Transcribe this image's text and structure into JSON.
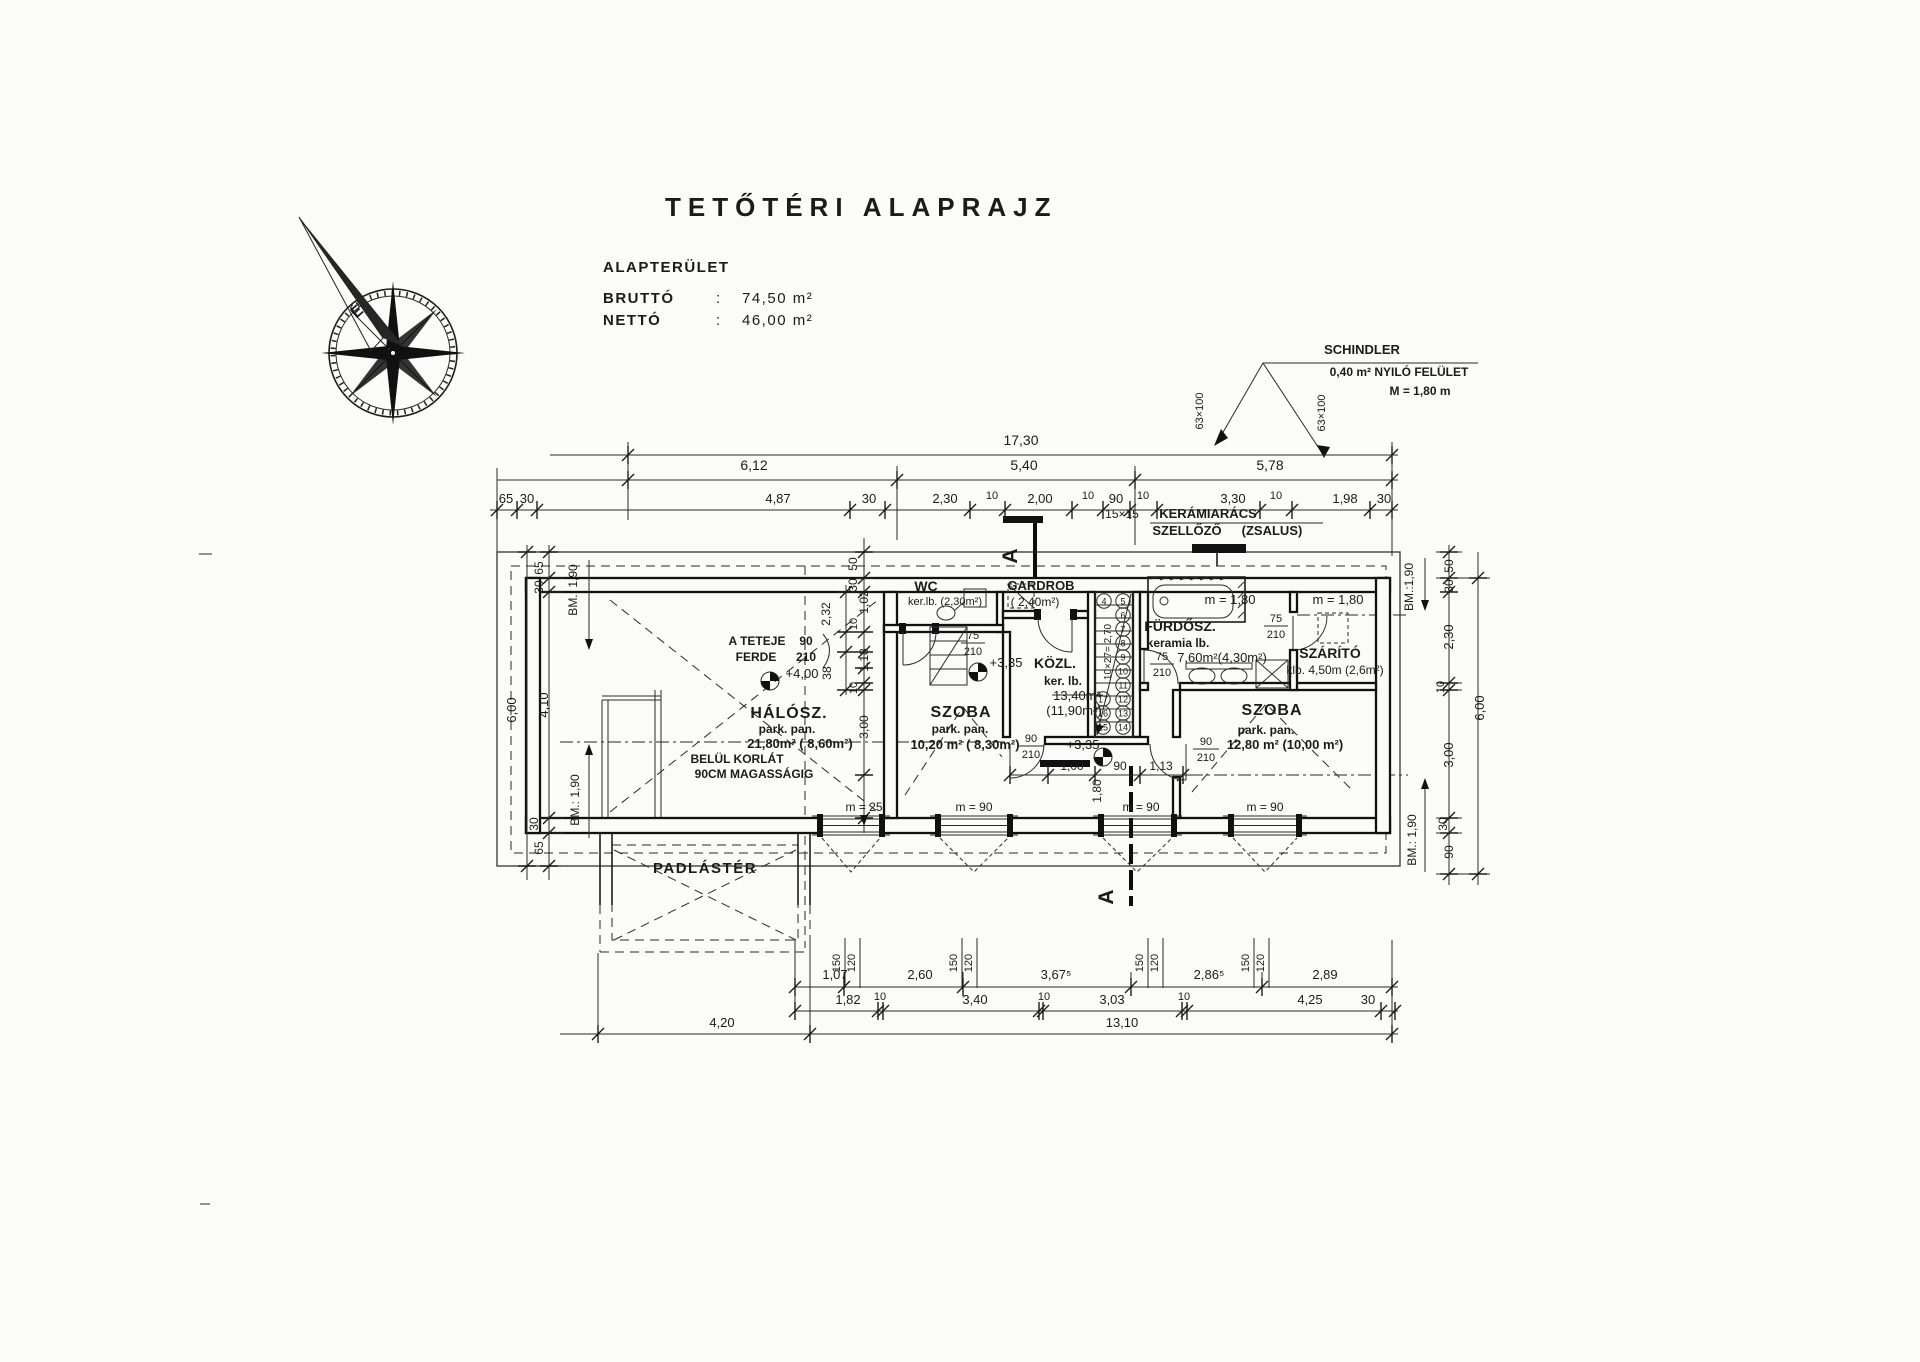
{
  "title": "TETŐTÉRI ALAPRAJZ",
  "area_table": {
    "heading": "ALAPTERÜLET",
    "rows": [
      {
        "label": "BRUTTÓ",
        "colon": ":",
        "value": "74,50 m²"
      },
      {
        "label": "NETTÓ",
        "colon": ":",
        "value": "46,00 m²"
      }
    ]
  },
  "compass": {
    "north_letter": "É"
  },
  "schindler": {
    "name": "SCHINDLER",
    "area": "0,40 m² NYILÓ FELÜLET",
    "height": "M = 1,80 m",
    "window_size_left": "63×100",
    "window_size_right": "63×100"
  },
  "vent": {
    "grid": "15×15",
    "name": "KERÁMIARÁCS",
    "type": "SZELLŐZŐ",
    "shutter": "(ZSALUS)"
  },
  "section": {
    "label_top": "A",
    "label_bottom": "A"
  },
  "levels": {
    "ridge": "+4,00",
    "floor1": "+3,35",
    "floor2": "+3,35"
  },
  "roof_note": {
    "line1_label": "A TETEJE",
    "line1_value": "90",
    "line2_label": "FERDE",
    "line2_value": "210"
  },
  "railing_note": {
    "line1": "BELÜL KORLÁT",
    "line2": "90CM MAGASSÁGIG"
  },
  "rooms": {
    "haloszoba": {
      "name": "HÁLÓSZ.",
      "finish": "park. pan.",
      "area": "21,80m² ( 8,60m²)"
    },
    "wc": {
      "name": "WC",
      "finish": "ker.lb. (2,30m²)"
    },
    "gardrob": {
      "name": "GARDROB",
      "area": "( 2,40m²)"
    },
    "kozlekedo": {
      "name": "KÖZL.",
      "finish": "ker. lb.",
      "area_gross": "13,40m²",
      "area_net": "(11,90m²)"
    },
    "furdoszoba": {
      "name": "FÜRDŐSZ.",
      "finish": "keramia lb.",
      "area": "7,60m²(4,30m²)",
      "tub_length": "m = 1,80"
    },
    "szarito": {
      "name": "SZÁRÍTÓ",
      "area": "klb. 4,50m (2,6m²)",
      "height": "m = 1,80"
    },
    "szoba_left": {
      "name": "SZOBA",
      "finish": "park. pan.",
      "area": "10,20 m² ( 8,30m²)"
    },
    "szoba_right": {
      "name": "SZOBA",
      "finish": "park. pan.",
      "area": "12,80 m² (10,00 m²)"
    },
    "padlaster": {
      "name": "PADLÁSTÉR"
    }
  },
  "stairs": {
    "run": "10×27= 2,70",
    "steps": [
      "4",
      "5",
      "6",
      "7",
      "8",
      "9",
      "10",
      "11",
      "12",
      "13",
      "14",
      "15",
      "16",
      "17"
    ]
  },
  "sills": {
    "w1": "m = 25",
    "w2": "m = 90",
    "w3": "m = 90",
    "w4": "m = 90"
  },
  "doors": {
    "d90a": {
      "w": "90",
      "h": "210"
    },
    "d90b": {
      "w": "90",
      "h": "210"
    },
    "d75a": {
      "w": "75",
      "h": "210"
    },
    "d75b": {
      "w": "75",
      "h": "210"
    },
    "d75c": {
      "w": "75",
      "h": "210"
    }
  },
  "dims": {
    "top_total": "17,30",
    "top_mid": [
      "6,12",
      "5,40",
      "5,78"
    ],
    "top_detail": [
      "65",
      "30",
      "4,87",
      "30",
      "2,30",
      "10",
      "2,00",
      "10",
      "90",
      "10",
      "3,30",
      "10",
      "1,98",
      "30"
    ],
    "bottom_row1": [
      "1,07",
      "2,60",
      "3,67⁵",
      "2,86⁵",
      "2,89"
    ],
    "bottom_row2": [
      "1,82",
      "10",
      "3,40",
      "10",
      "3,03",
      "10",
      "4,25",
      "30"
    ],
    "bottom_left": "4,20",
    "bottom_total": "13,10",
    "window_pairs": [
      "150",
      "120",
      "150",
      "120",
      "150",
      "120",
      "150",
      "120"
    ],
    "left_outer": "6,00",
    "left_chain": [
      "65",
      "30",
      "4,10",
      "30",
      "65"
    ],
    "right_outer": "6,00",
    "right_chain": [
      "50",
      "30",
      "2,30",
      "10",
      "3,00",
      "30",
      "90"
    ],
    "bm": [
      "BM.: 1,90",
      "BM.: 1,90",
      "BM.:1,90",
      "BM.: 1,90"
    ],
    "inner_left": [
      "50",
      "30",
      "2,32",
      "1,02",
      "10",
      "1,18",
      "38",
      "10",
      "3,00"
    ],
    "inner_mid": [
      "1,00",
      "90",
      "1,13",
      "1,80"
    ]
  }
}
